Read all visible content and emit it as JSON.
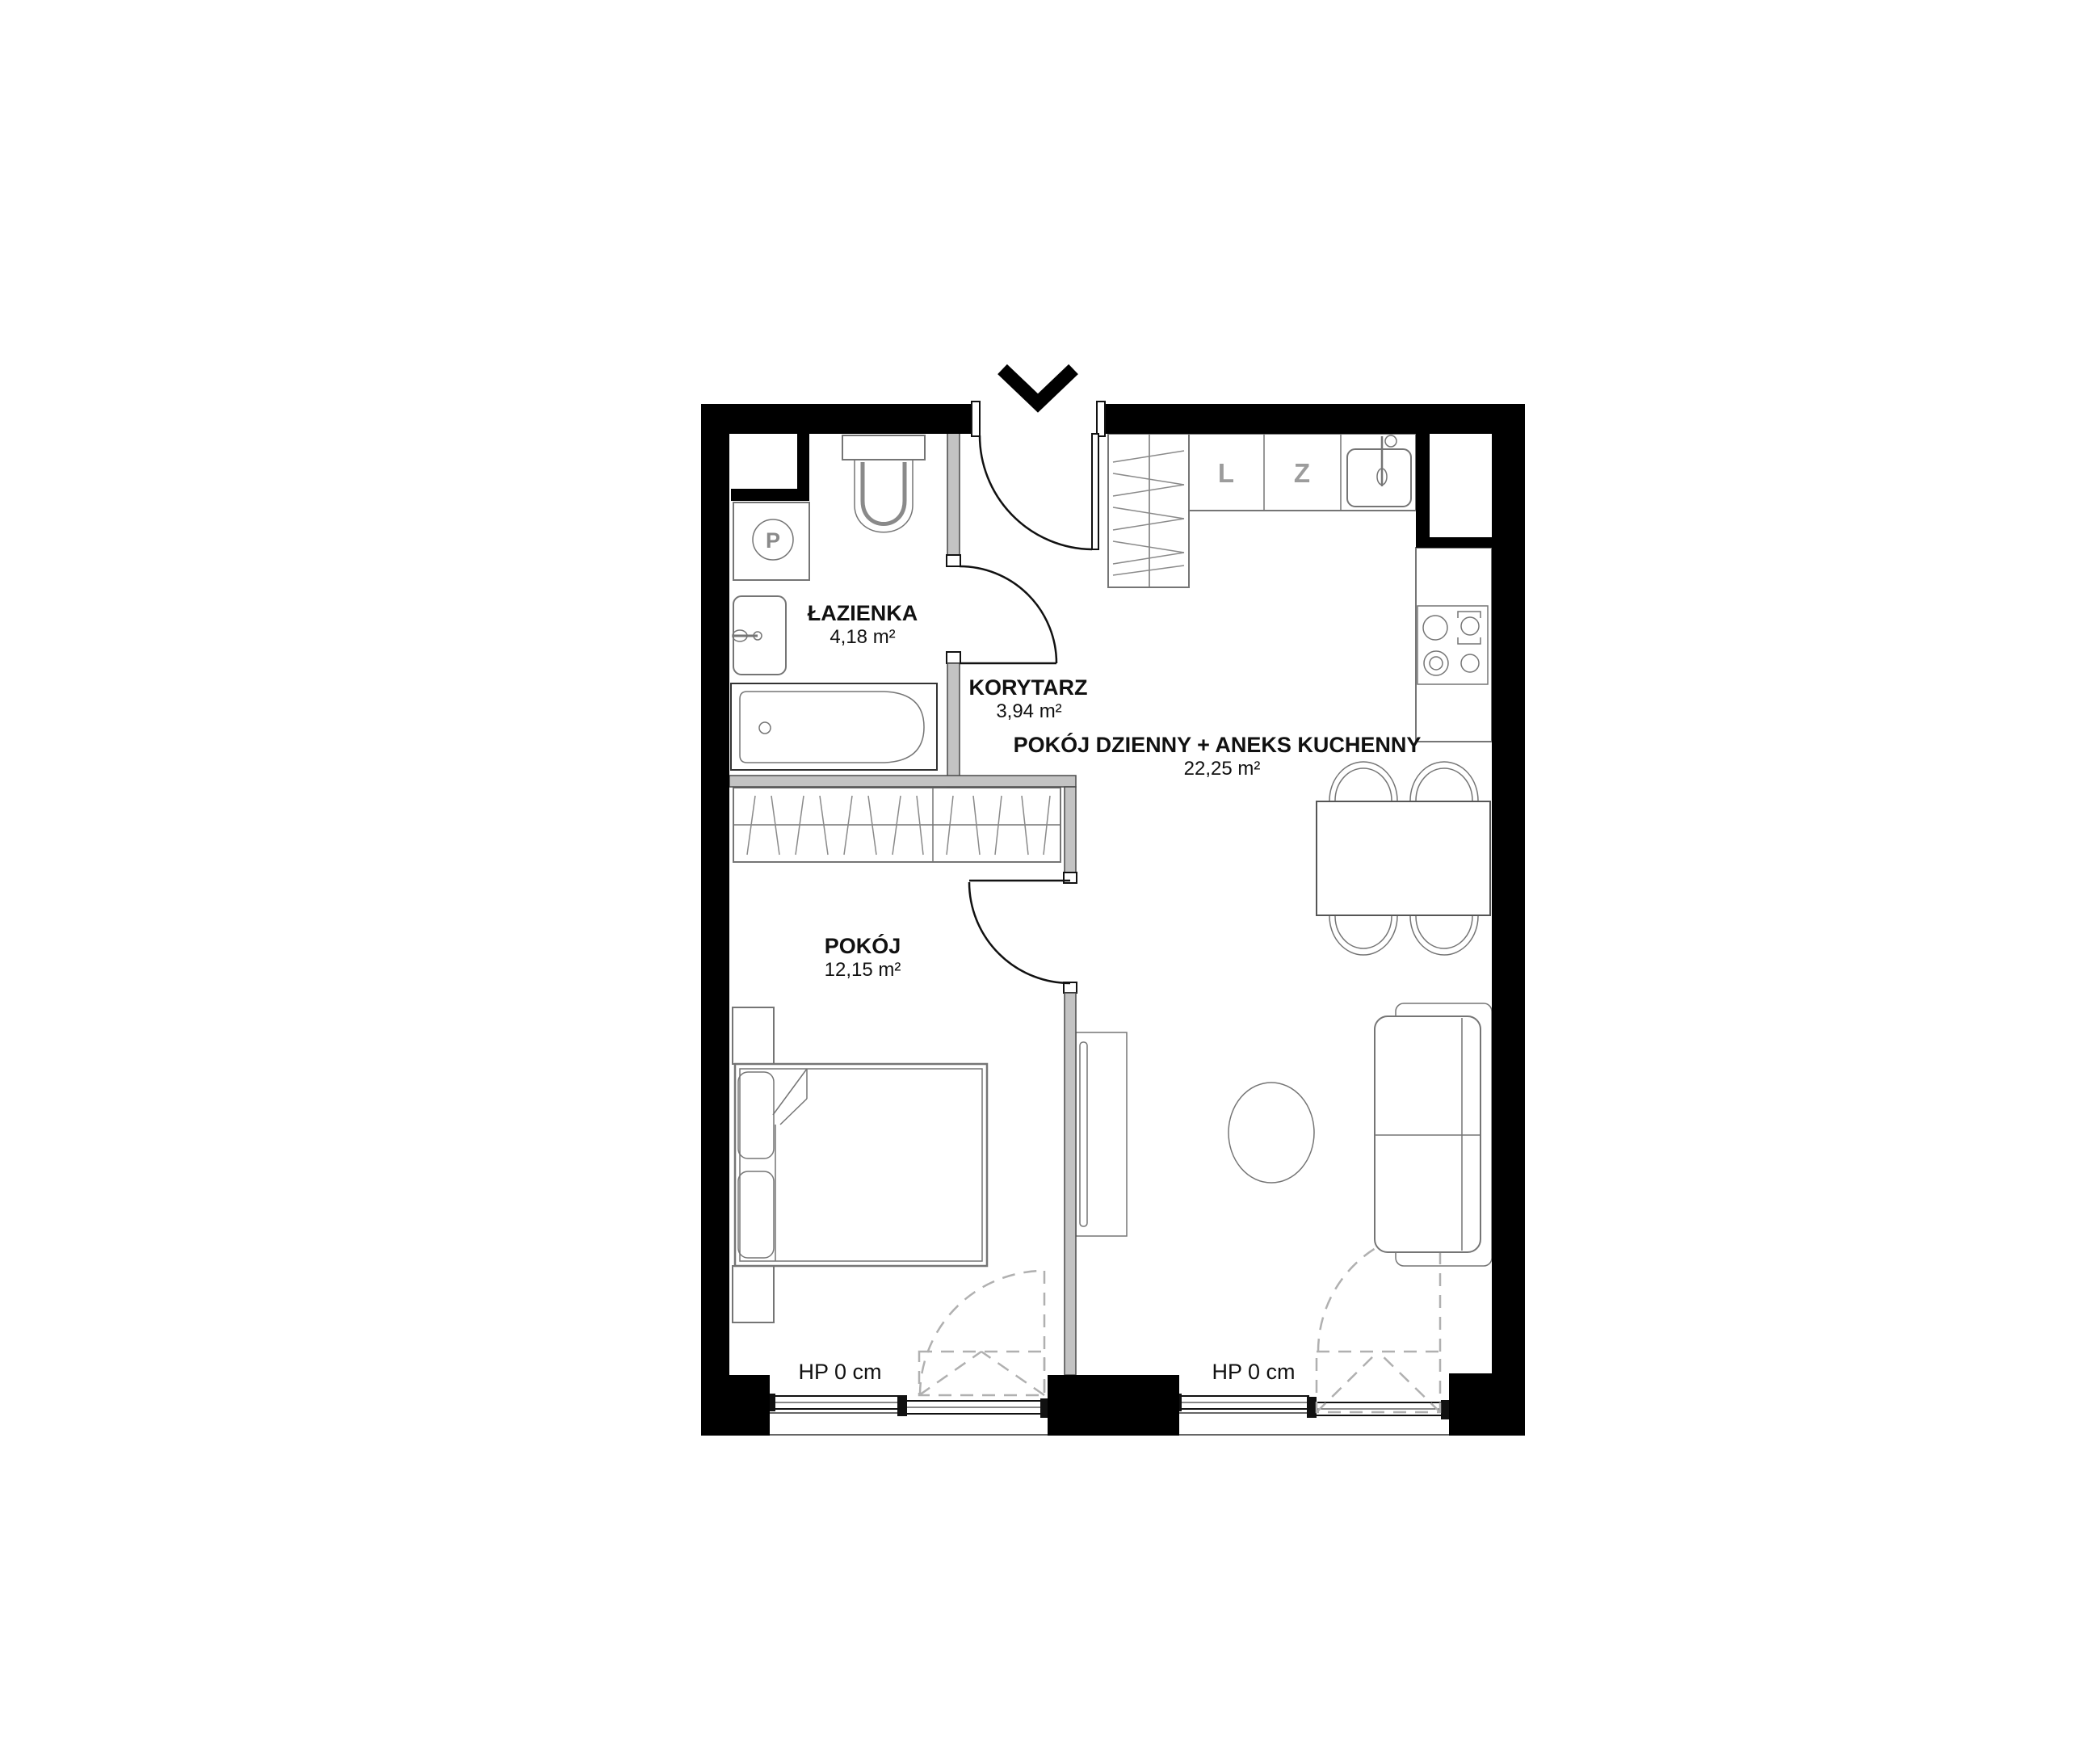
{
  "floorplan": {
    "rooms": {
      "bathroom": {
        "name": "ŁAZIENKA",
        "area": "4,18 m²"
      },
      "corridor": {
        "name": "KORYTARZ",
        "area": "3,94 m²"
      },
      "living_kitchen": {
        "name": "POKÓJ DZIENNY + ANEKS KUCHENNY",
        "area": "22,25 m²"
      },
      "bedroom": {
        "name": "POKÓJ",
        "area": "12,15 m²"
      }
    },
    "window_labels": {
      "left": "HP 0 cm",
      "right": "HP 0 cm"
    },
    "appliance_letters": {
      "washer": "P",
      "kitchen_l": "L",
      "kitchen_z": "Z"
    },
    "colors": {
      "wall": "#000000",
      "partition": "#c3c3c3",
      "furniture_line": "#757575",
      "dashed_symbol": "#b0b0b0",
      "text": "#111111",
      "kitchen_letter": "#9c9c9c"
    }
  }
}
